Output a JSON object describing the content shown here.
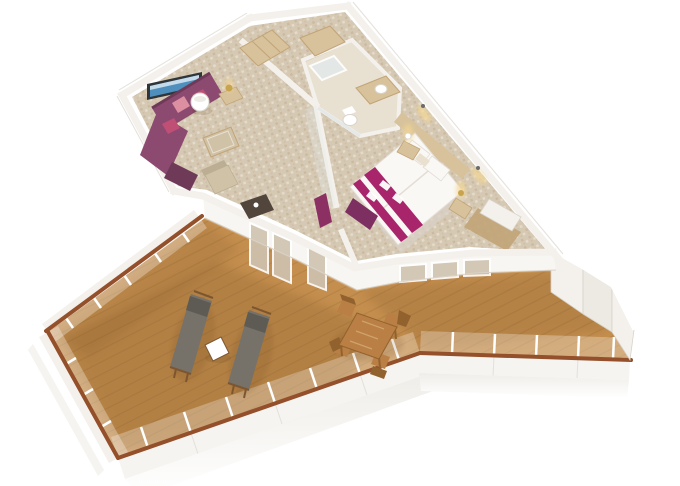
{
  "scene": {
    "type": "3d-isometric-floorplan-render",
    "subject": "cruise-ship-suite-with-wraparound-balcony",
    "rooms": [
      {
        "name": "living-room",
        "furniture": [
          "corner-sofa",
          "chaise",
          "pillows",
          "drum-floor-lamp",
          "side-table-lamp",
          "coffee-table",
          "armchair",
          "desk",
          "wall-tv"
        ]
      },
      {
        "name": "entry",
        "furniture": [
          "wardrobe-closet-left",
          "wardrobe-closet-right"
        ]
      },
      {
        "name": "bathroom",
        "furniture": [
          "shower",
          "vanity-sink",
          "toilet"
        ]
      },
      {
        "name": "bedroom",
        "furniture": [
          "double-bed",
          "bed-runners",
          "towels",
          "pillows",
          "foot-bench",
          "purple-wardrobe-panel",
          "nightstand-left",
          "nightstand-right",
          "wall-sconces",
          "closet-nook"
        ]
      },
      {
        "name": "balcony",
        "furniture": [
          "sun-lounger-left",
          "sun-lounger-right",
          "white-side-table",
          "dining-table",
          "dining-chairs"
        ]
      }
    ],
    "balcony_features": [
      "teak-deck",
      "glass-balustrade",
      "wood-handrail",
      "white-hull-fascia",
      "privacy-partition-panels"
    ]
  },
  "colors": {
    "background": "#ffffff",
    "white": "#ffffff",
    "wall": "#f4f1ec",
    "wall_face": "#f8f6f2",
    "wall_shade": "#eceae3",
    "wall_edge": "#d8d3ca",
    "carpet": "#d6c9b4",
    "carpet_dark": "#c1ad92",
    "carpet_light": "#e9e0cf",
    "bath_floor": "#e8e1d1",
    "wood_light": "#d7c29c",
    "wood_mid": "#c2a477",
    "glass": "#cfc3b0",
    "glass_faint": "#e3e8e8",
    "deck": "#c48e4e",
    "deck_light": "#d6a469",
    "deck_shadow": "#5f3e13",
    "rail": "#93502a",
    "balustrade_face": "#f5f4f0",
    "hull": "#efede8",
    "sofa": "#8c4a71",
    "sofa_dark": "#6e3a58",
    "pillow_pink": "#dc8fa0",
    "pillow_magenta": "#bf4f74",
    "bed_white": "#faf8f5",
    "bed_shadow": "#d9d2c8",
    "bed_seam": "#e3ddd5",
    "runner": "#a8256b",
    "bench": "#7c2f60",
    "purple_panel": "#8c2f63",
    "tv_frame": "#30353a",
    "tv_screen": "#4f8fbe",
    "tv_sky": "#cfe3ef",
    "brass": "#c9a44e",
    "glow": "#f3d794",
    "lounger": "#76726a",
    "lounger_dark": "#5e5b54",
    "frame_wood": "#7d5630",
    "dining_wood": "#b97f45",
    "dining_dark": "#92622e",
    "dining_light": "#d9b27c",
    "desk": "#52463c",
    "armchair": "#cfc2a6",
    "armchair_dark": "#bbae92",
    "lamp_rim": "#d9d4cb",
    "fixture": "#6b6b6b",
    "porcelain_edge": "#d9d4cc"
  }
}
